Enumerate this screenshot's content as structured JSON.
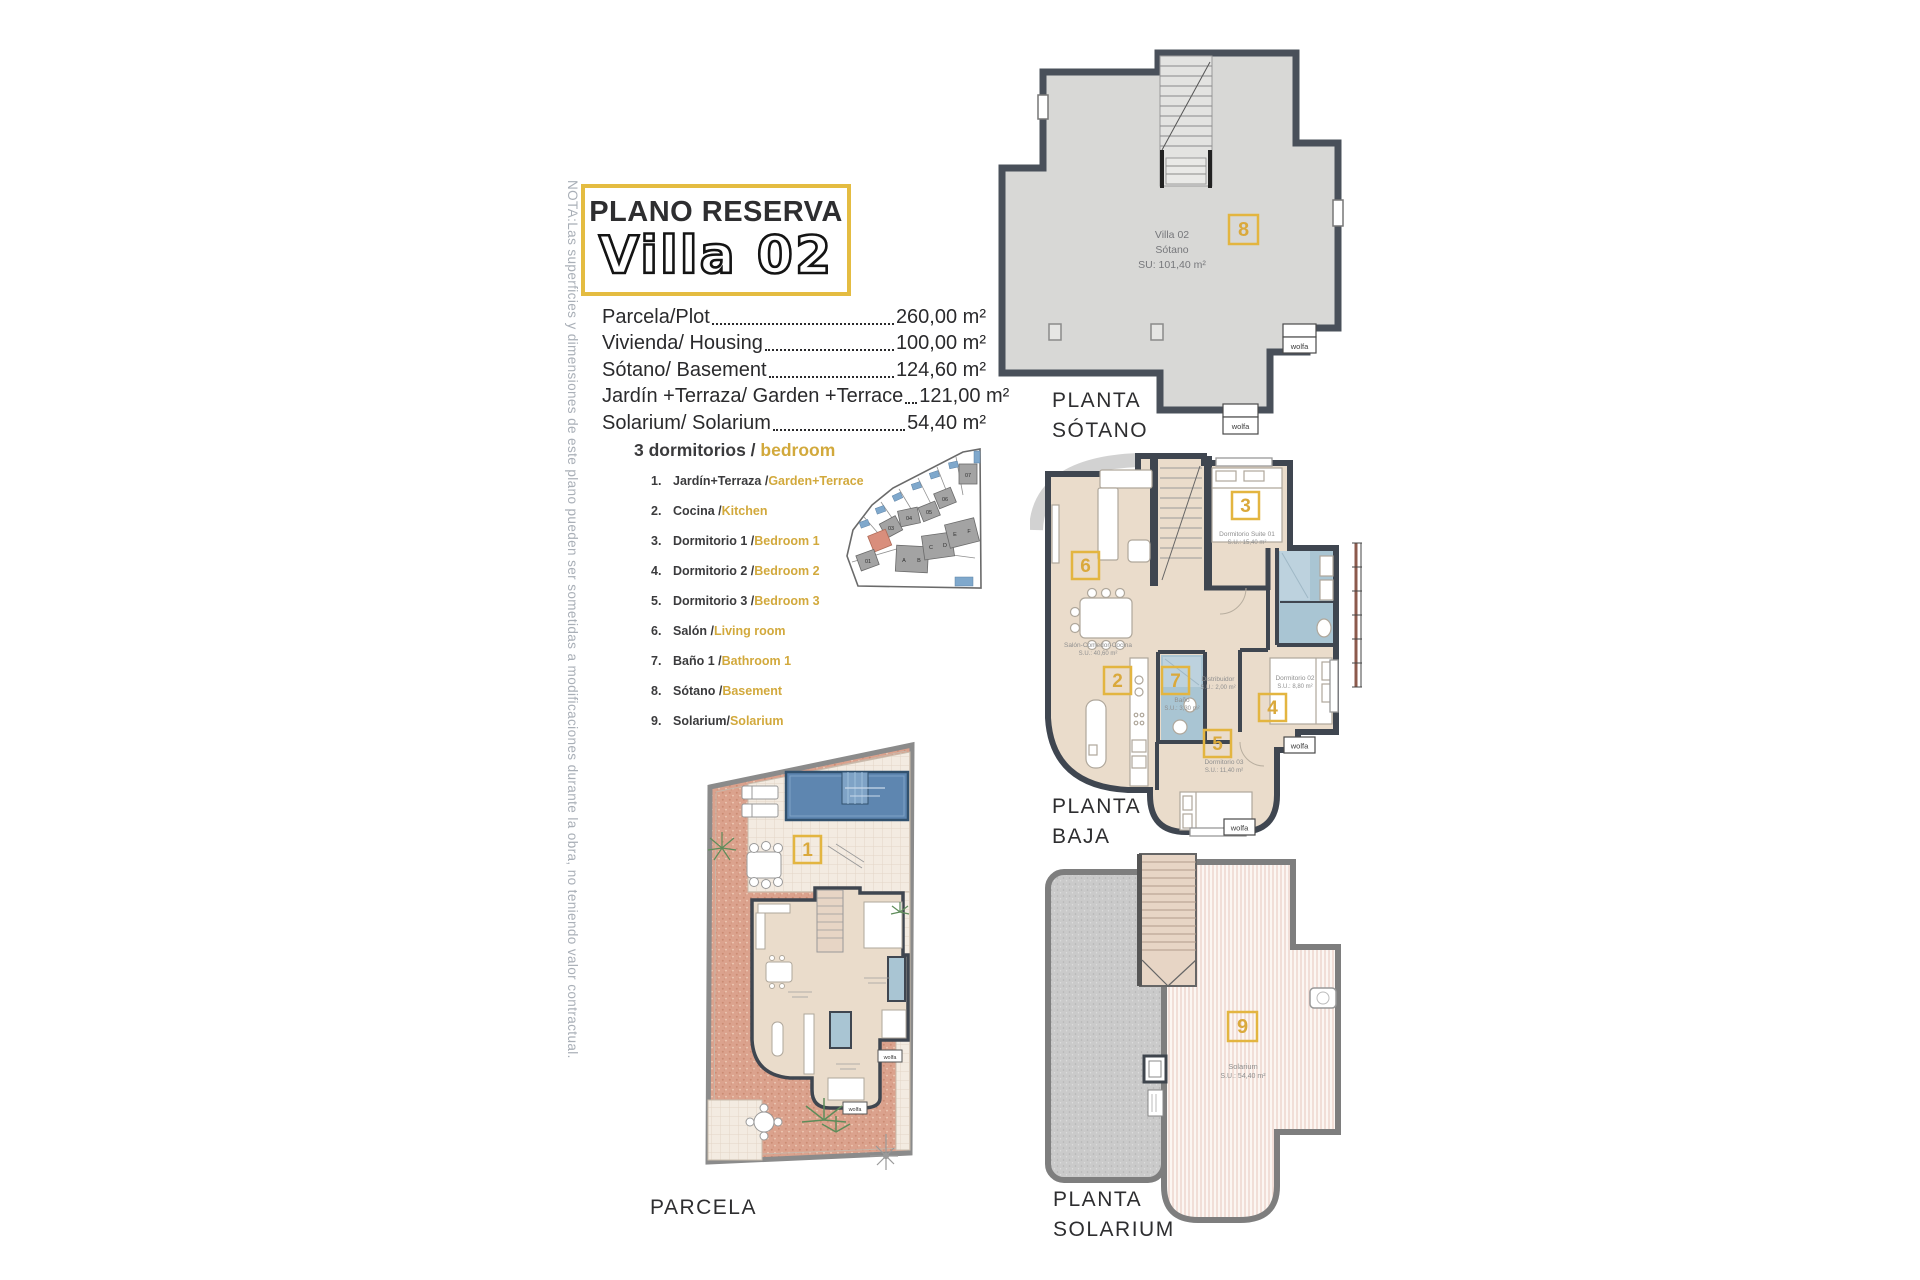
{
  "note": "NOTA:Las superficies y dimensiones de este plano pueden ser sometidas a modificaciones durante la obra, no teniendo valor contractual.",
  "title": {
    "kicker": "PLANO RESERVA",
    "name": "Villa 02"
  },
  "areas": [
    {
      "label": "Parcela/Plot",
      "value": "260,00 m²"
    },
    {
      "label": "Vivienda/ Housing",
      "value": "100,00 m²"
    },
    {
      "label": "Sótano/ Basement",
      "value": "124,60 m²"
    },
    {
      "label": "Jardín +Terraza/ Garden +Terrace",
      "value": "121,00 m²"
    },
    {
      "label": "Solarium/ Solarium",
      "value": "54,40 m²"
    }
  ],
  "legend": {
    "heading_es": "3 dormitorios / ",
    "heading_en": "bedroom",
    "items": [
      {
        "num": "1.",
        "es": "Jardín+Terraza / ",
        "en": "Garden+Terrace"
      },
      {
        "num": "2.",
        "es": "Cocina / ",
        "en": "Kitchen"
      },
      {
        "num": "3.",
        "es": "Dormitorio 1 / ",
        "en": "Bedroom 1"
      },
      {
        "num": "4.",
        "es": "Dormitorio 2 / ",
        "en": "Bedroom 2"
      },
      {
        "num": "5.",
        "es": "Dormitorio 3 / ",
        "en": "Bedroom 3"
      },
      {
        "num": "6.",
        "es": "Salón / ",
        "en": "Living room"
      },
      {
        "num": "7.",
        "es": "Baño 1 / ",
        "en": "Bathroom 1"
      },
      {
        "num": "8.",
        "es": "Sótano /",
        "en": "Basement"
      },
      {
        "num": "9.",
        "es": "Solarium/",
        "en": "Solarium"
      }
    ]
  },
  "brand": "wolfa",
  "sitemap": {
    "labels": [
      "01",
      "03",
      "04",
      "05",
      "06",
      "07",
      "A",
      "B",
      "C",
      "D",
      "E",
      "F"
    ]
  },
  "plans": {
    "sotano": {
      "label1": "PLANTA",
      "label2": "SÓTANO",
      "number": "8",
      "line1": "Villa 02",
      "line2": "Sótano",
      "line3": "SU: 101,40 m²"
    },
    "baja": {
      "label1": "PLANTA",
      "label2": "BAJA",
      "salon_number": "6",
      "salon_name": "Salón-Comedor-Cocina",
      "salon_su": "S.U.: 40,60 m²",
      "suite_number": "3",
      "suite_name": "Dormitorio Suite 01",
      "suite_su": "S.U.: 15,40 m²",
      "cocina_number": "2",
      "bano_number": "7",
      "bano_name": "Baño",
      "bano_su": "S.U.: 3,30 m²",
      "distribuidor_name": "Distribuidor",
      "distribuidor_su": "S.U.: 2,00 m²",
      "dorm2_number": "4",
      "dorm2_name": "Dormitorio 02",
      "dorm2_su": "S.U.: 8,80 m²",
      "dorm3_number": "5",
      "dorm3_name": "Dormitorio 03",
      "dorm3_su": "S.U.: 11,40 m²"
    },
    "parcela": {
      "label": "PARCELA",
      "number": "1"
    },
    "solarium": {
      "label1": "PLANTA",
      "label2": "SOLARIUM",
      "number": "9",
      "name": "Solarium",
      "su": "S.U.: 54,40 m²"
    }
  },
  "colors": {
    "accent": "#E3B540",
    "wall_dark": "#454C56",
    "basement_fill": "#D8D8D6",
    "room_fill": "#EADCCB",
    "bath_fill": "#A9C5D3",
    "garden_terracotta": "#DBA28D",
    "pool_blue": "#5E86B0",
    "note_gray": "#A9AFB7"
  }
}
